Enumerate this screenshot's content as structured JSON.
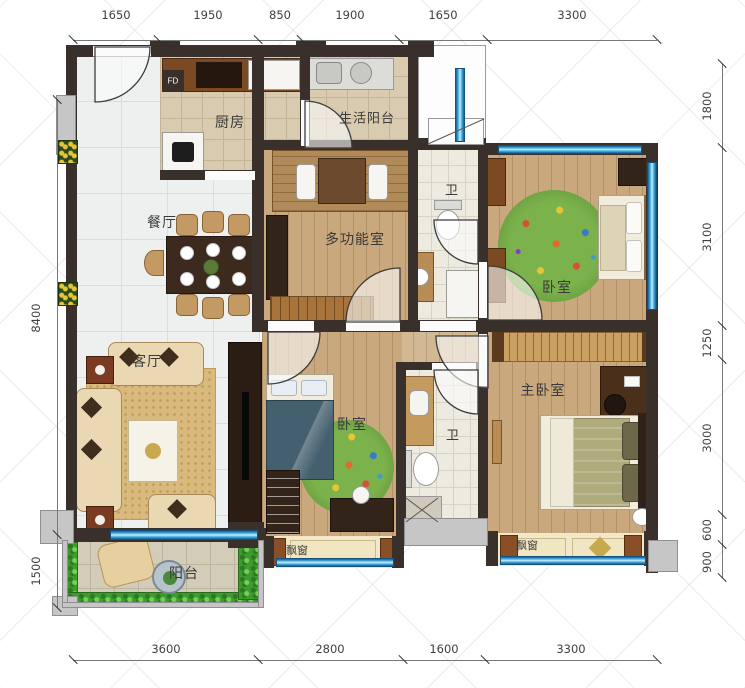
{
  "plan_type": "apartment-floor-plan",
  "rooms": {
    "kitchen": "厨房",
    "service_balcony": "生活阳台",
    "dining": "餐厅",
    "multifunction": "多功能室",
    "bath_top": "卫",
    "bedroom_ne": "卧室",
    "living": "客厅",
    "bedroom_mid": "卧室",
    "bath_mid": "卫",
    "master_bedroom": "主卧室",
    "balcony": "阳台",
    "bay_window_left": "飘窗",
    "bay_window_right": "飘窗",
    "fd_shaft": "FD"
  },
  "dims": {
    "top": [
      "1650",
      "1950",
      "850",
      "1900",
      "1650",
      "3300"
    ],
    "bottom": [
      "3600",
      "2800",
      "1600",
      "3300"
    ],
    "left": [
      "8400",
      "1500"
    ],
    "right": [
      "1800",
      "3100",
      "1250",
      "3000",
      "600",
      "900"
    ]
  },
  "colors": {
    "wall": "#3a302b",
    "window_blue": "#0e5f9e",
    "wood_floor": "#c9a87e",
    "marble_tile": "#eef0f0",
    "rug_green": "#7cb24c"
  }
}
